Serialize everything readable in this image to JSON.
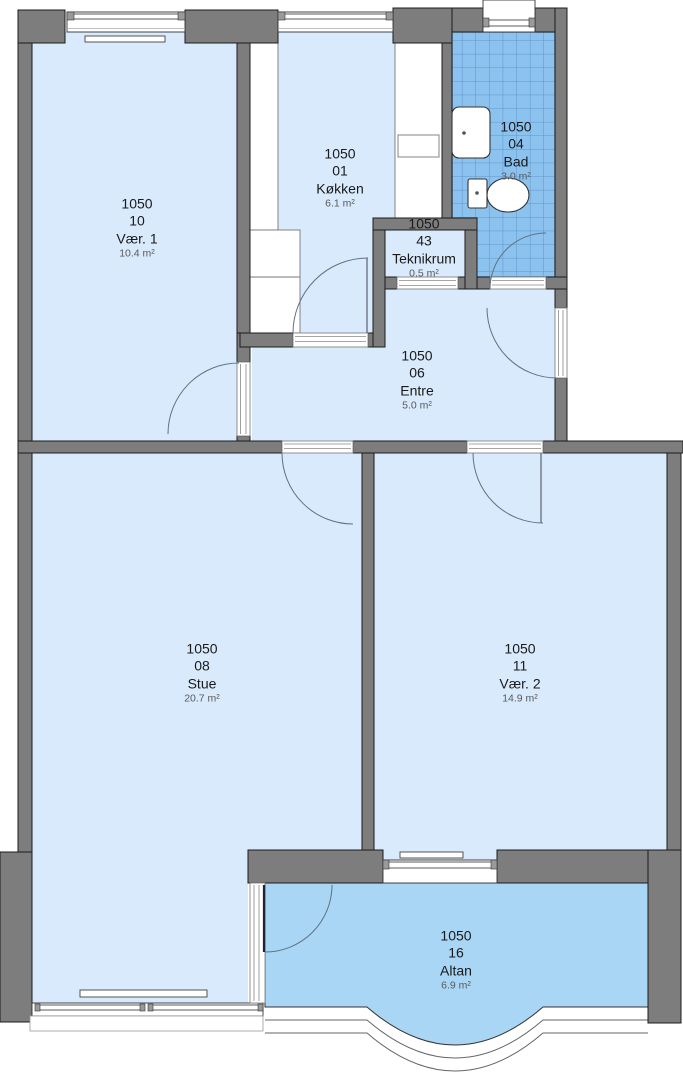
{
  "plan": {
    "rooms": [
      {
        "key": "vaer1",
        "code": "1050",
        "number": "10",
        "name": "Vær. 1",
        "area": "10.4 m²"
      },
      {
        "key": "kokken",
        "code": "1050",
        "number": "01",
        "name": "Køkken",
        "area": "6.1 m²"
      },
      {
        "key": "bad",
        "code": "1050",
        "number": "04",
        "name": "Bad",
        "area": "3.0 m²"
      },
      {
        "key": "teknikrum",
        "code": "1050",
        "number": "43",
        "name": "Teknikrum",
        "area": "0.5 m²"
      },
      {
        "key": "entre",
        "code": "1050",
        "number": "06",
        "name": "Entre",
        "area": "5.0 m²"
      },
      {
        "key": "stue",
        "code": "1050",
        "number": "08",
        "name": "Stue",
        "area": "20.7 m²"
      },
      {
        "key": "vaer2",
        "code": "1050",
        "number": "11",
        "name": "Vær. 2",
        "area": "14.9 m²"
      },
      {
        "key": "altan",
        "code": "1050",
        "number": "16",
        "name": "Altan",
        "area": "6.9 m²"
      }
    ],
    "colors": {
      "wall": "#7d7d7d",
      "floor": "#d9eafc",
      "balcony": "#a9d6f4",
      "tile": "#8cc2ee",
      "tile_grid": "#5e95cc",
      "outline": "#1c1c1c",
      "arc": "#5f7285"
    }
  }
}
